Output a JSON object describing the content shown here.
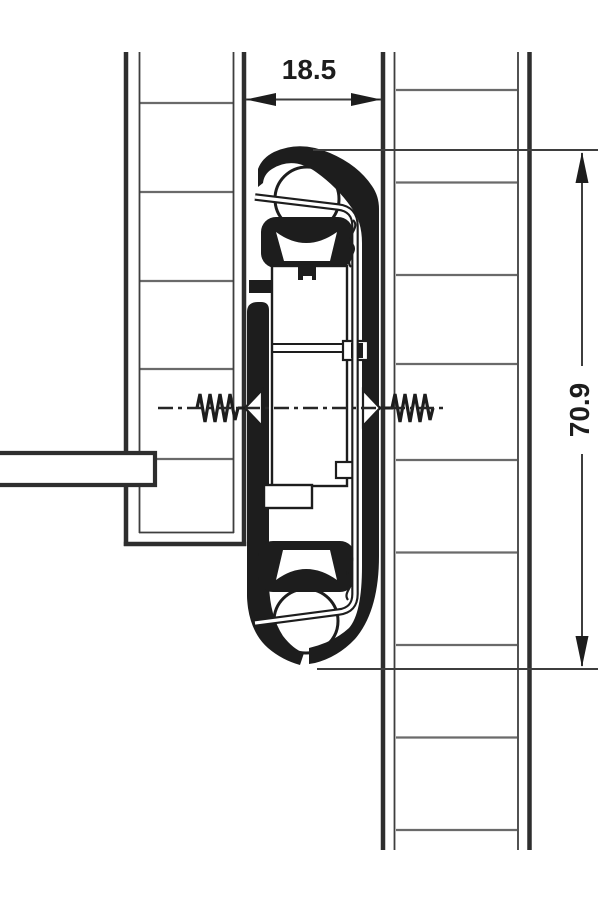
{
  "drawing": {
    "type": "drawer-slide cross-section technical drawing",
    "labels": {
      "width_mm": "18.5",
      "height_mm": "70.9"
    },
    "colors": {
      "ink": "#1d1d1d",
      "panel_edge": "#2e2e2e",
      "thin_line": "#3e3e3e",
      "hatch": "#6a6a6a",
      "background": "#ffffff"
    }
  }
}
